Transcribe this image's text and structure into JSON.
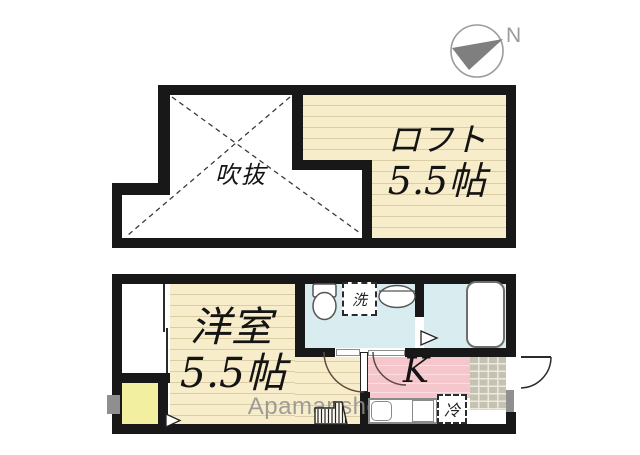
{
  "compass": {
    "north_label": "N"
  },
  "watermark": {
    "text": "Apamanshop"
  },
  "upper_floor": {
    "atrium": {
      "label": "吹抜"
    },
    "loft": {
      "label": "ロフト",
      "size": "5.5帖"
    }
  },
  "lower_floor": {
    "western_room": {
      "label": "洋室",
      "size": "5.5帖"
    },
    "kitchen": {
      "label": "K"
    },
    "washing_machine": {
      "label": "洗"
    },
    "refrigerator": {
      "label": "冷"
    }
  },
  "colors": {
    "wall": "#181818",
    "floor_cream": "#f8edca",
    "floor_stripe": "#dbcda3",
    "kitchen_pink": "#f5c7cd",
    "water_cyan": "#d9edf1",
    "service_yellow": "#f2efa0",
    "entrance_tile": "#c6c2b2",
    "watermark_gray": "#8f8f8f"
  }
}
